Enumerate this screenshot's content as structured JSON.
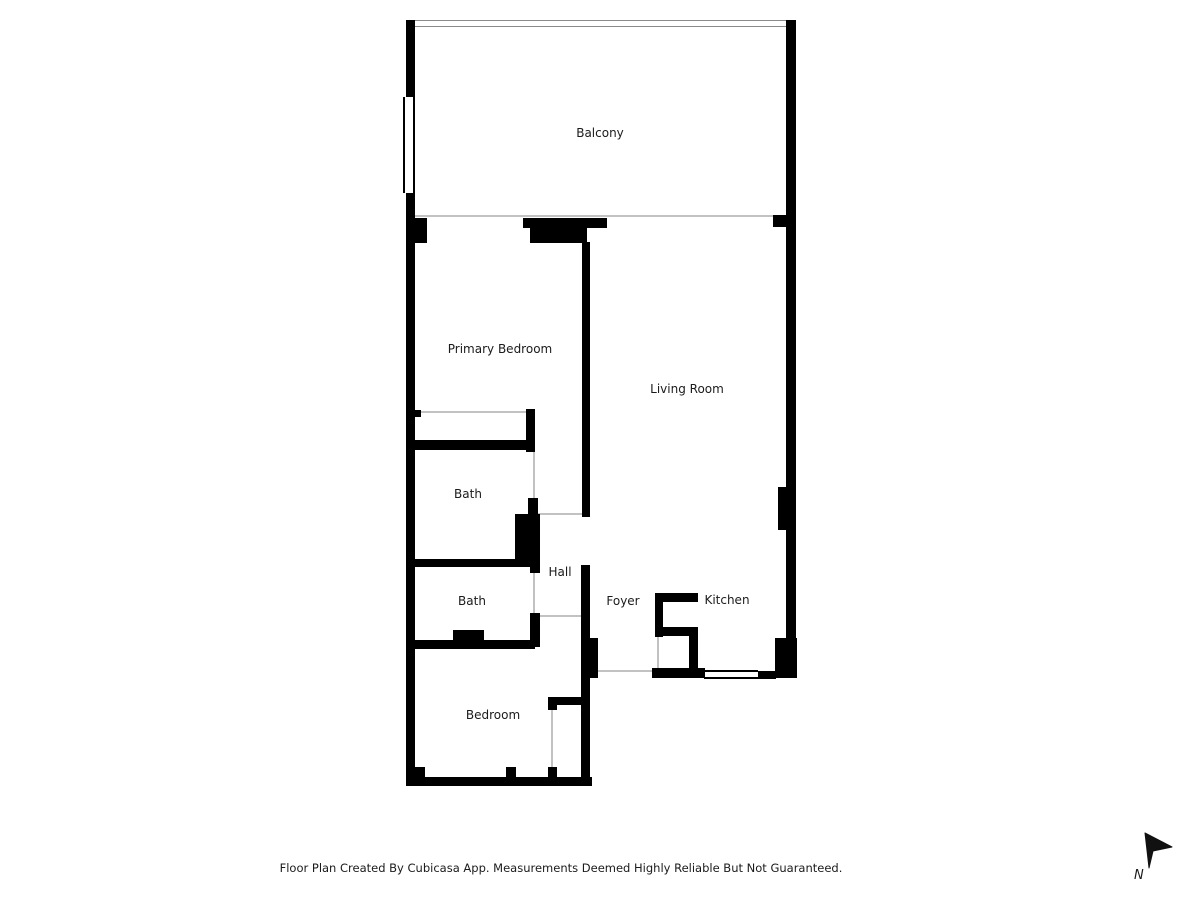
{
  "colors": {
    "wall": "#000000",
    "opening_line": "#c2c2c2",
    "window_border": "#000000",
    "railing_line": "#8a8a8a",
    "text": "#1b1b1b"
  },
  "rooms": [
    {
      "id": "balcony",
      "label": "Balcony",
      "cx": 600,
      "cy": 133
    },
    {
      "id": "primary-bedroom",
      "label": "Primary Bedroom",
      "cx": 500,
      "cy": 349
    },
    {
      "id": "living-room",
      "label": "Living Room",
      "cx": 687,
      "cy": 389
    },
    {
      "id": "bath-1",
      "label": "Bath",
      "cx": 468,
      "cy": 494
    },
    {
      "id": "hall",
      "label": "Hall",
      "cx": 560,
      "cy": 572
    },
    {
      "id": "bath-2",
      "label": "Bath",
      "cx": 472,
      "cy": 601
    },
    {
      "id": "foyer",
      "label": "Foyer",
      "cx": 623,
      "cy": 601
    },
    {
      "id": "kitchen",
      "label": "Kitchen",
      "cx": 727,
      "cy": 600
    },
    {
      "id": "bedroom",
      "label": "Bedroom",
      "cx": 493,
      "cy": 715
    }
  ],
  "walls": [
    {
      "id": "balcony-left-upper",
      "x": 406,
      "y": 20,
      "w": 9,
      "h": 77
    },
    {
      "id": "balcony-left-lower",
      "x": 406,
      "y": 193,
      "w": 9,
      "h": 25
    },
    {
      "id": "exterior-right",
      "x": 786,
      "y": 20,
      "w": 10,
      "h": 658
    },
    {
      "id": "exterior-left",
      "x": 406,
      "y": 218,
      "w": 9,
      "h": 568
    },
    {
      "id": "bedroom-bottom",
      "x": 406,
      "y": 777,
      "w": 186,
      "h": 9
    },
    {
      "id": "entry-bottom",
      "x": 652,
      "y": 668,
      "w": 53,
      "h": 10
    },
    {
      "id": "kitchen-bottom-right",
      "x": 758,
      "y": 671,
      "w": 18,
      "h": 8
    },
    {
      "id": "corner-block-bottom-right",
      "x": 775,
      "y": 638,
      "w": 22,
      "h": 40
    },
    {
      "id": "living-room-pilaster",
      "x": 778,
      "y": 487,
      "w": 8,
      "h": 43
    },
    {
      "id": "bedroom-corner-block",
      "x": 406,
      "y": 767,
      "w": 19,
      "h": 19
    },
    {
      "id": "bedroom-window-stub",
      "x": 506,
      "y": 767,
      "w": 10,
      "h": 11
    },
    {
      "id": "balcony-stub-left",
      "x": 408,
      "y": 218,
      "w": 19,
      "h": 25
    },
    {
      "id": "balcony-door-bar",
      "x": 523,
      "y": 218,
      "w": 84,
      "h": 10
    },
    {
      "id": "balcony-door-block",
      "x": 530,
      "y": 228,
      "w": 57,
      "h": 15
    },
    {
      "id": "balcony-stub-right",
      "x": 773,
      "y": 215,
      "w": 13,
      "h": 12
    },
    {
      "id": "primary-living-divider",
      "x": 582,
      "y": 242,
      "w": 8,
      "h": 275
    },
    {
      "id": "hall-right",
      "x": 581,
      "y": 565,
      "w": 9,
      "h": 75
    },
    {
      "id": "foyer-block",
      "x": 581,
      "y": 638,
      "w": 17,
      "h": 40
    },
    {
      "id": "bedroom-right",
      "x": 581,
      "y": 675,
      "w": 9,
      "h": 111
    },
    {
      "id": "primary-closet-stub",
      "x": 415,
      "y": 410,
      "w": 6,
      "h": 7
    },
    {
      "id": "primary-closet-right",
      "x": 526,
      "y": 409,
      "w": 9,
      "h": 43
    },
    {
      "id": "primary-closet-bottom",
      "x": 406,
      "y": 440,
      "w": 129,
      "h": 10
    },
    {
      "id": "bath1-right-lower",
      "x": 528,
      "y": 498,
      "w": 10,
      "h": 17
    },
    {
      "id": "hall-block",
      "x": 515,
      "y": 514,
      "w": 25,
      "h": 51
    },
    {
      "id": "bath-divider",
      "x": 406,
      "y": 559,
      "w": 132,
      "h": 8
    },
    {
      "id": "bath2-stub-top",
      "x": 530,
      "y": 565,
      "w": 10,
      "h": 8
    },
    {
      "id": "bath2-stub-bottom",
      "x": 530,
      "y": 613,
      "w": 10,
      "h": 34
    },
    {
      "id": "bath2-bottom",
      "x": 406,
      "y": 640,
      "w": 129,
      "h": 9
    },
    {
      "id": "bath2-fixture",
      "x": 453,
      "y": 630,
      "w": 31,
      "h": 12
    },
    {
      "id": "kitchen-counter-top",
      "x": 655,
      "y": 593,
      "w": 43,
      "h": 9
    },
    {
      "id": "kitchen-counter-left",
      "x": 655,
      "y": 593,
      "w": 8,
      "h": 44
    },
    {
      "id": "kitchen-counter-mid",
      "x": 655,
      "y": 627,
      "w": 43,
      "h": 9
    },
    {
      "id": "kitchen-counter-right",
      "x": 689,
      "y": 627,
      "w": 9,
      "h": 50
    },
    {
      "id": "bedroom-closet-top",
      "x": 548,
      "y": 697,
      "w": 35,
      "h": 8
    },
    {
      "id": "bedroom-closet-stub-top",
      "x": 548,
      "y": 697,
      "w": 9,
      "h": 13
    },
    {
      "id": "bedroom-closet-stub-bottom",
      "x": 548,
      "y": 767,
      "w": 9,
      "h": 10
    }
  ],
  "windows": [
    {
      "id": "balcony-window-left",
      "x": 403,
      "y": 97,
      "w": 12,
      "h": 96,
      "orient": "v",
      "type": "window"
    },
    {
      "id": "bedroom-window",
      "x": 424,
      "y": 777,
      "w": 84,
      "h": 9,
      "orient": "h",
      "type": "window"
    },
    {
      "id": "kitchen-window",
      "x": 704,
      "y": 670,
      "w": 54,
      "h": 9,
      "orient": "h",
      "type": "window"
    },
    {
      "id": "balcony-railing",
      "x": 406,
      "y": 20,
      "w": 390,
      "h": 7,
      "orient": "h",
      "type": "railing"
    }
  ],
  "openings": [
    {
      "id": "balcony-slider-line",
      "x": 415,
      "y": 215,
      "w": 371,
      "h": 2
    },
    {
      "id": "primary-closet-slider",
      "x": 420,
      "y": 411,
      "w": 106,
      "h": 2
    },
    {
      "id": "hall-door-top",
      "x": 538,
      "y": 513,
      "w": 44,
      "h": 2
    },
    {
      "id": "hall-door-bottom",
      "x": 538,
      "y": 615,
      "w": 44,
      "h": 2
    },
    {
      "id": "entry-door",
      "x": 598,
      "y": 670,
      "w": 54,
      "h": 2
    },
    {
      "id": "bath1-door",
      "x": 533,
      "y": 452,
      "w": 2,
      "h": 46
    },
    {
      "id": "bath2-door",
      "x": 533,
      "y": 573,
      "w": 2,
      "h": 40
    },
    {
      "id": "kitchen-closet-door",
      "x": 657,
      "y": 637,
      "w": 2,
      "h": 31
    },
    {
      "id": "bedroom-closet-door",
      "x": 551,
      "y": 710,
      "w": 2,
      "h": 57
    }
  ],
  "footer": {
    "text": "Floor Plan Created By Cubicasa App. Measurements Deemed Highly Reliable But Not Guaranteed."
  },
  "compass": {
    "label": "N"
  }
}
